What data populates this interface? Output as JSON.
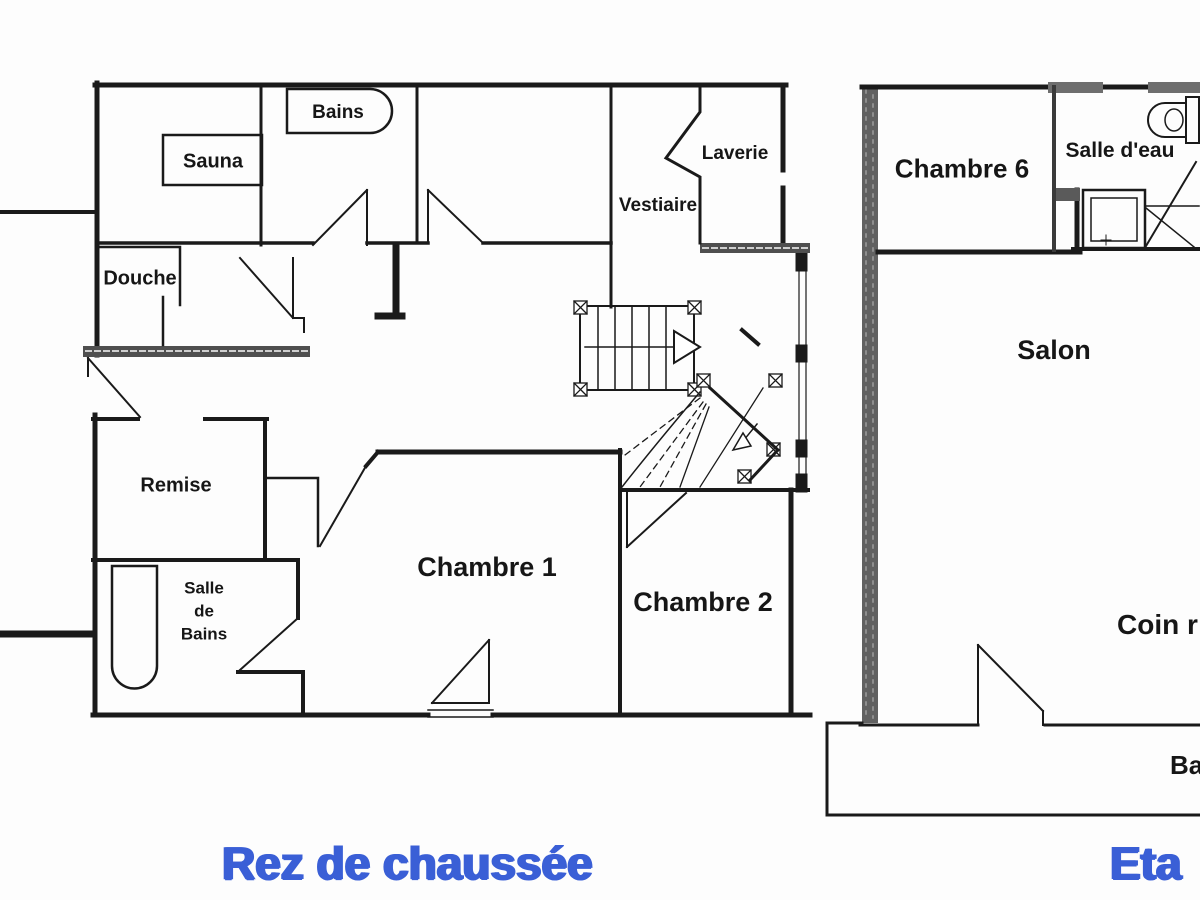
{
  "left_plan": {
    "title": "Rez de chaussée",
    "rooms": {
      "bains": "Bains",
      "sauna": "Sauna",
      "douche": "Douche",
      "laverie": "Laverie",
      "vestiaire": "Vestiaire",
      "remise": "Remise",
      "salle_de_bains_l1": "Salle",
      "salle_de_bains_l2": "de",
      "salle_de_bains_l3": "Bains",
      "chambre1": "Chambre 1",
      "chambre2": "Chambre 2"
    }
  },
  "right_plan": {
    "title": "Eta",
    "rooms": {
      "chambre6": "Chambre 6",
      "salle_eau": "Salle d'eau",
      "salon": "Salon",
      "coin": "Coin r",
      "balcon": "Ba"
    }
  },
  "icons": {
    "bathtub_top": "bathtub-icon",
    "bathtub_bottom": "bathtub-icon",
    "toilet": "toilet-icon",
    "shower": "shower-icon",
    "stairs": "stairs-icon"
  },
  "colors": {
    "title_blue": "#3a5fd6",
    "wall_black": "#1a1a1a",
    "wall_gray": "#616161"
  }
}
